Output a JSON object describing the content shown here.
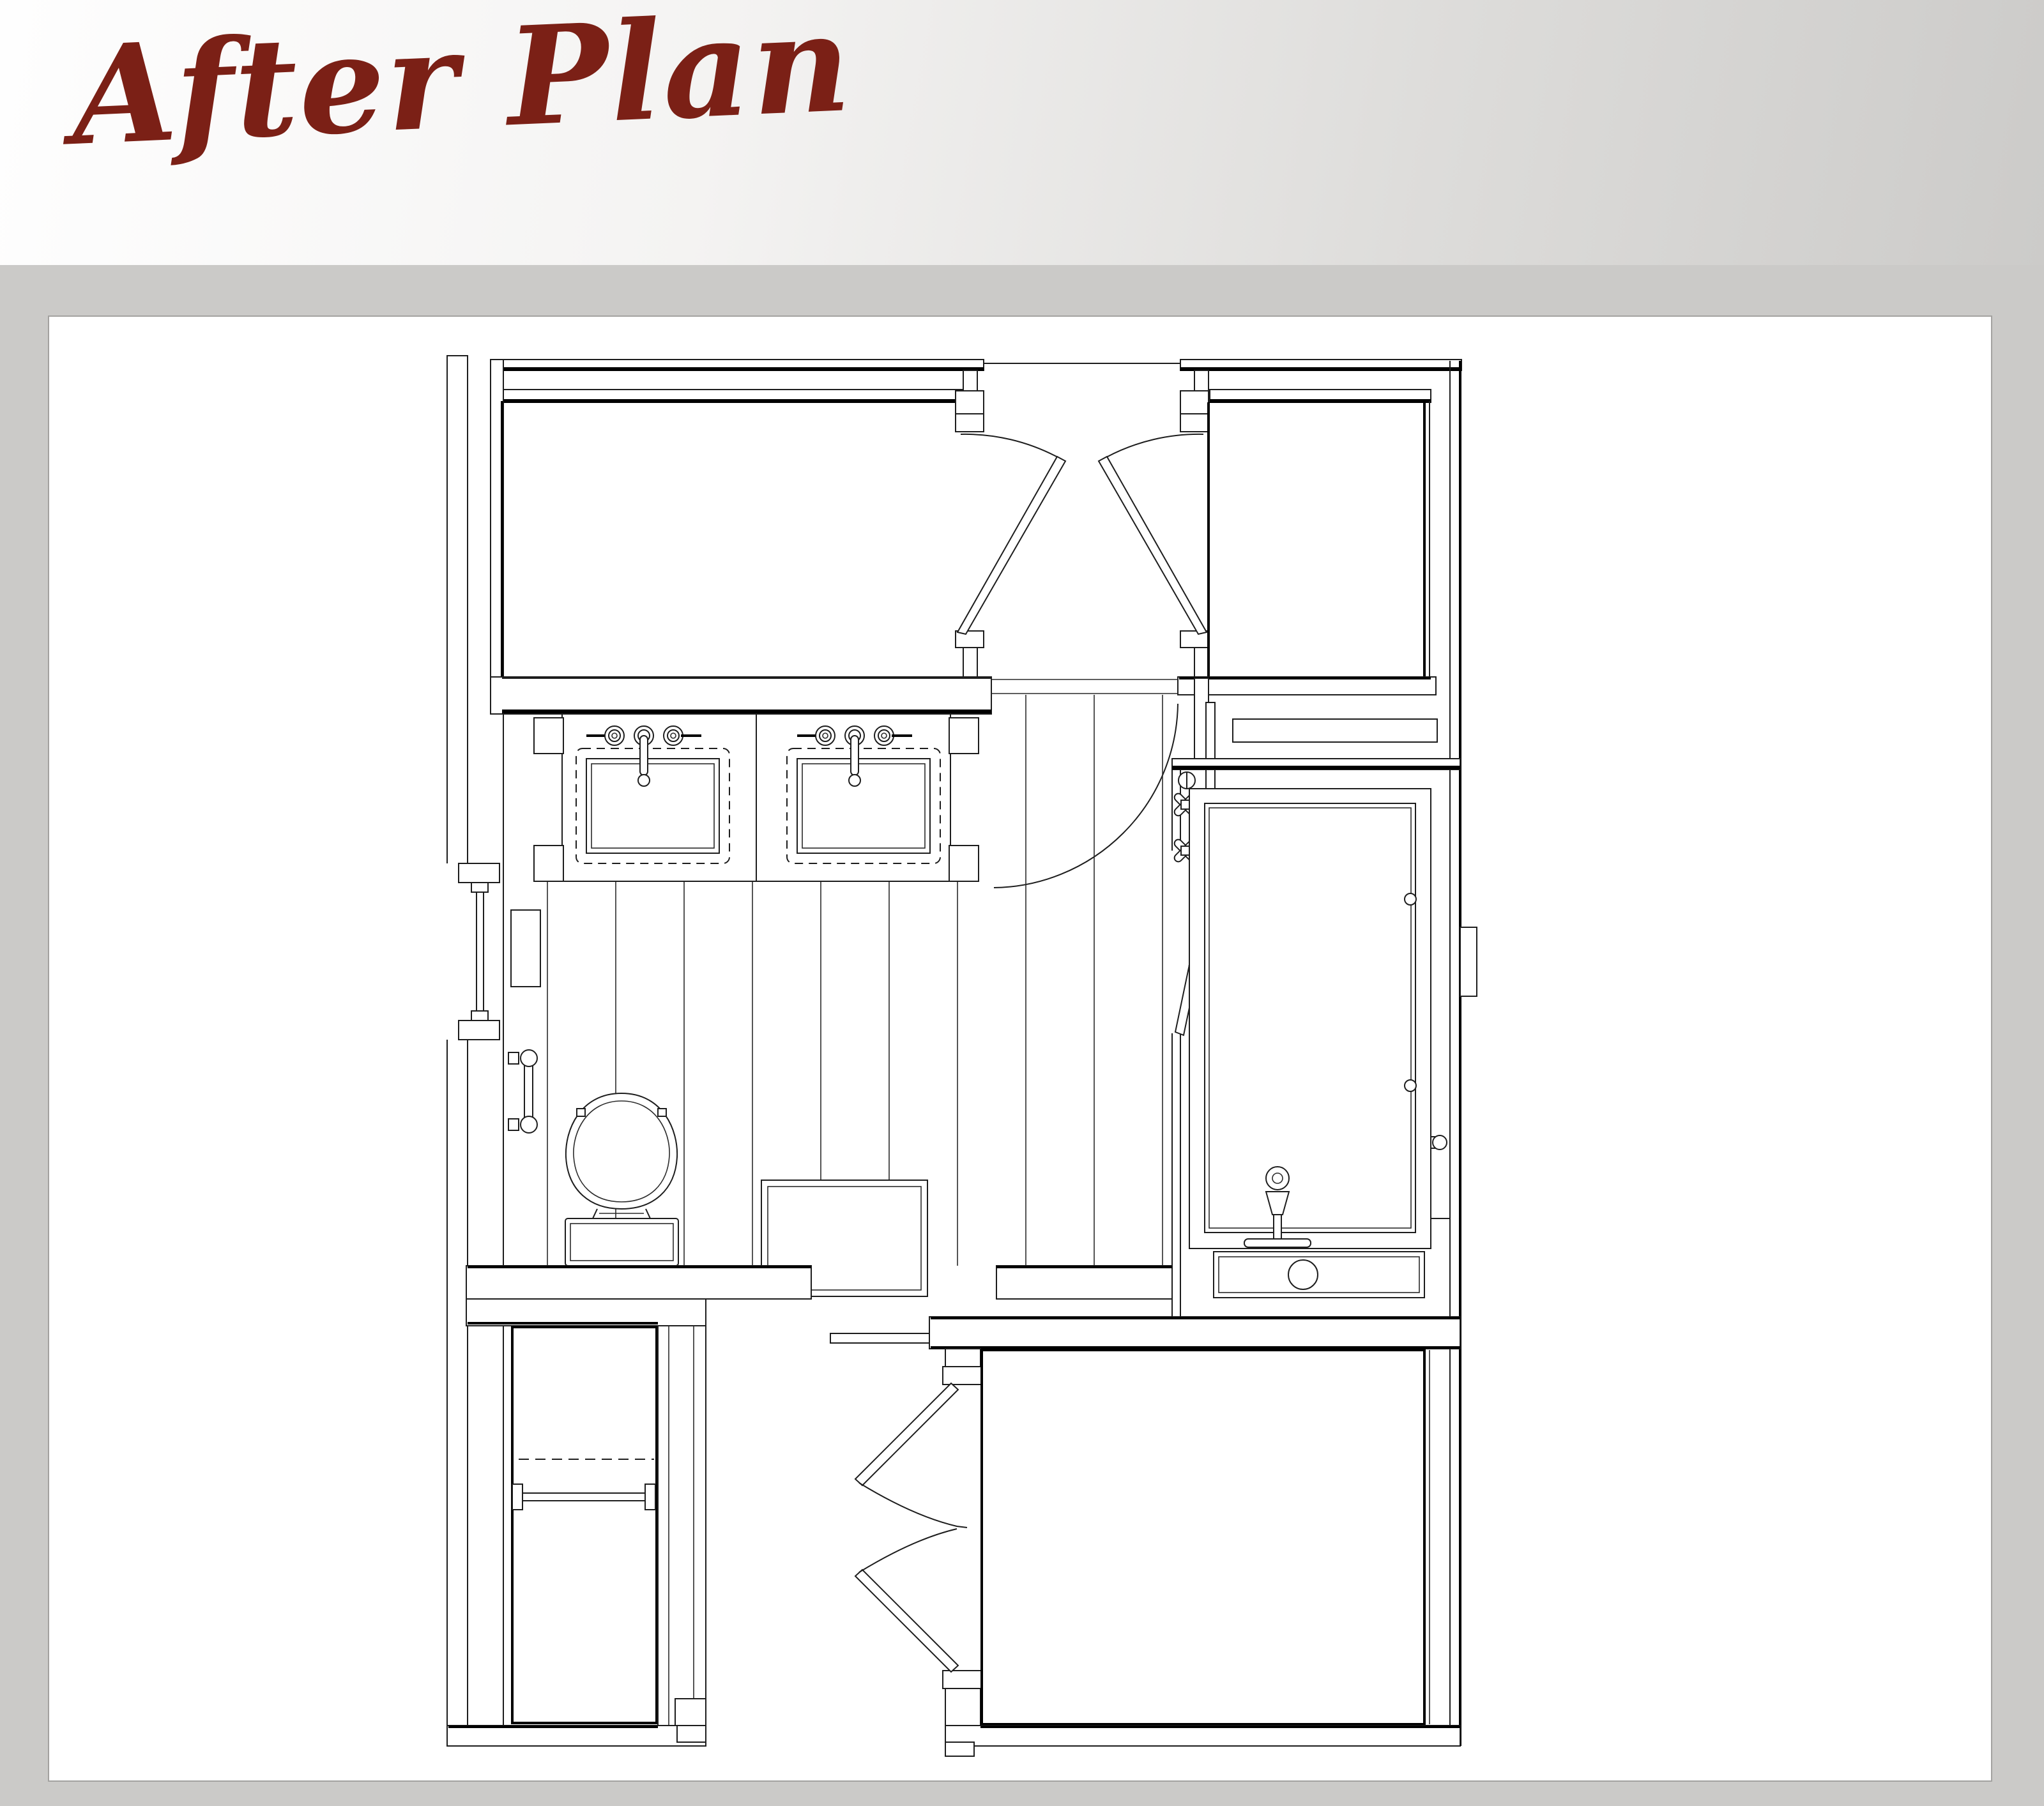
{
  "header": {
    "title": "After Plan",
    "title_color": "#7b2016",
    "gradient_from": "#fefefe",
    "gradient_to": "#cccbc9"
  },
  "canvas": {
    "page_background": "#cbcac8",
    "panel_background": "#ffffff",
    "panel_border": "#a3a2a0",
    "drawing_line_color": "#1d1d1d"
  },
  "plan": {
    "type": "architectural-floor-plan",
    "subject": "master bathroom remodel - after condition",
    "rooms": [
      {
        "name": "walk-in-closet-top-left"
      },
      {
        "name": "bedroom-top-right"
      },
      {
        "name": "entry-vestibule"
      },
      {
        "name": "master-bathroom"
      },
      {
        "name": "linen-closet-bottom-left"
      },
      {
        "name": "hall-bottom-center"
      },
      {
        "name": "bedroom-bottom-right"
      }
    ],
    "fixtures": [
      {
        "name": "double-vanity",
        "sinks": 2,
        "faucet_holes_per_sink": 3
      },
      {
        "name": "toilet-with-tank"
      },
      {
        "name": "bathtub"
      },
      {
        "name": "tub-filler-faucet"
      },
      {
        "name": "shower-valve-cross-handles",
        "count": 2
      },
      {
        "name": "glass-tub-door"
      },
      {
        "name": "towel-bar"
      },
      {
        "name": "window-left-wall"
      },
      {
        "name": "wall-niche"
      },
      {
        "name": "under-tub-drawer",
        "knobs": 1
      },
      {
        "name": "shower-bench"
      },
      {
        "name": "closet-rod-and-shelf"
      },
      {
        "name": "swing-doors",
        "count": 3
      },
      {
        "name": "bifold-doors",
        "count": 1
      },
      {
        "name": "wood-plank-flooring"
      }
    ]
  }
}
